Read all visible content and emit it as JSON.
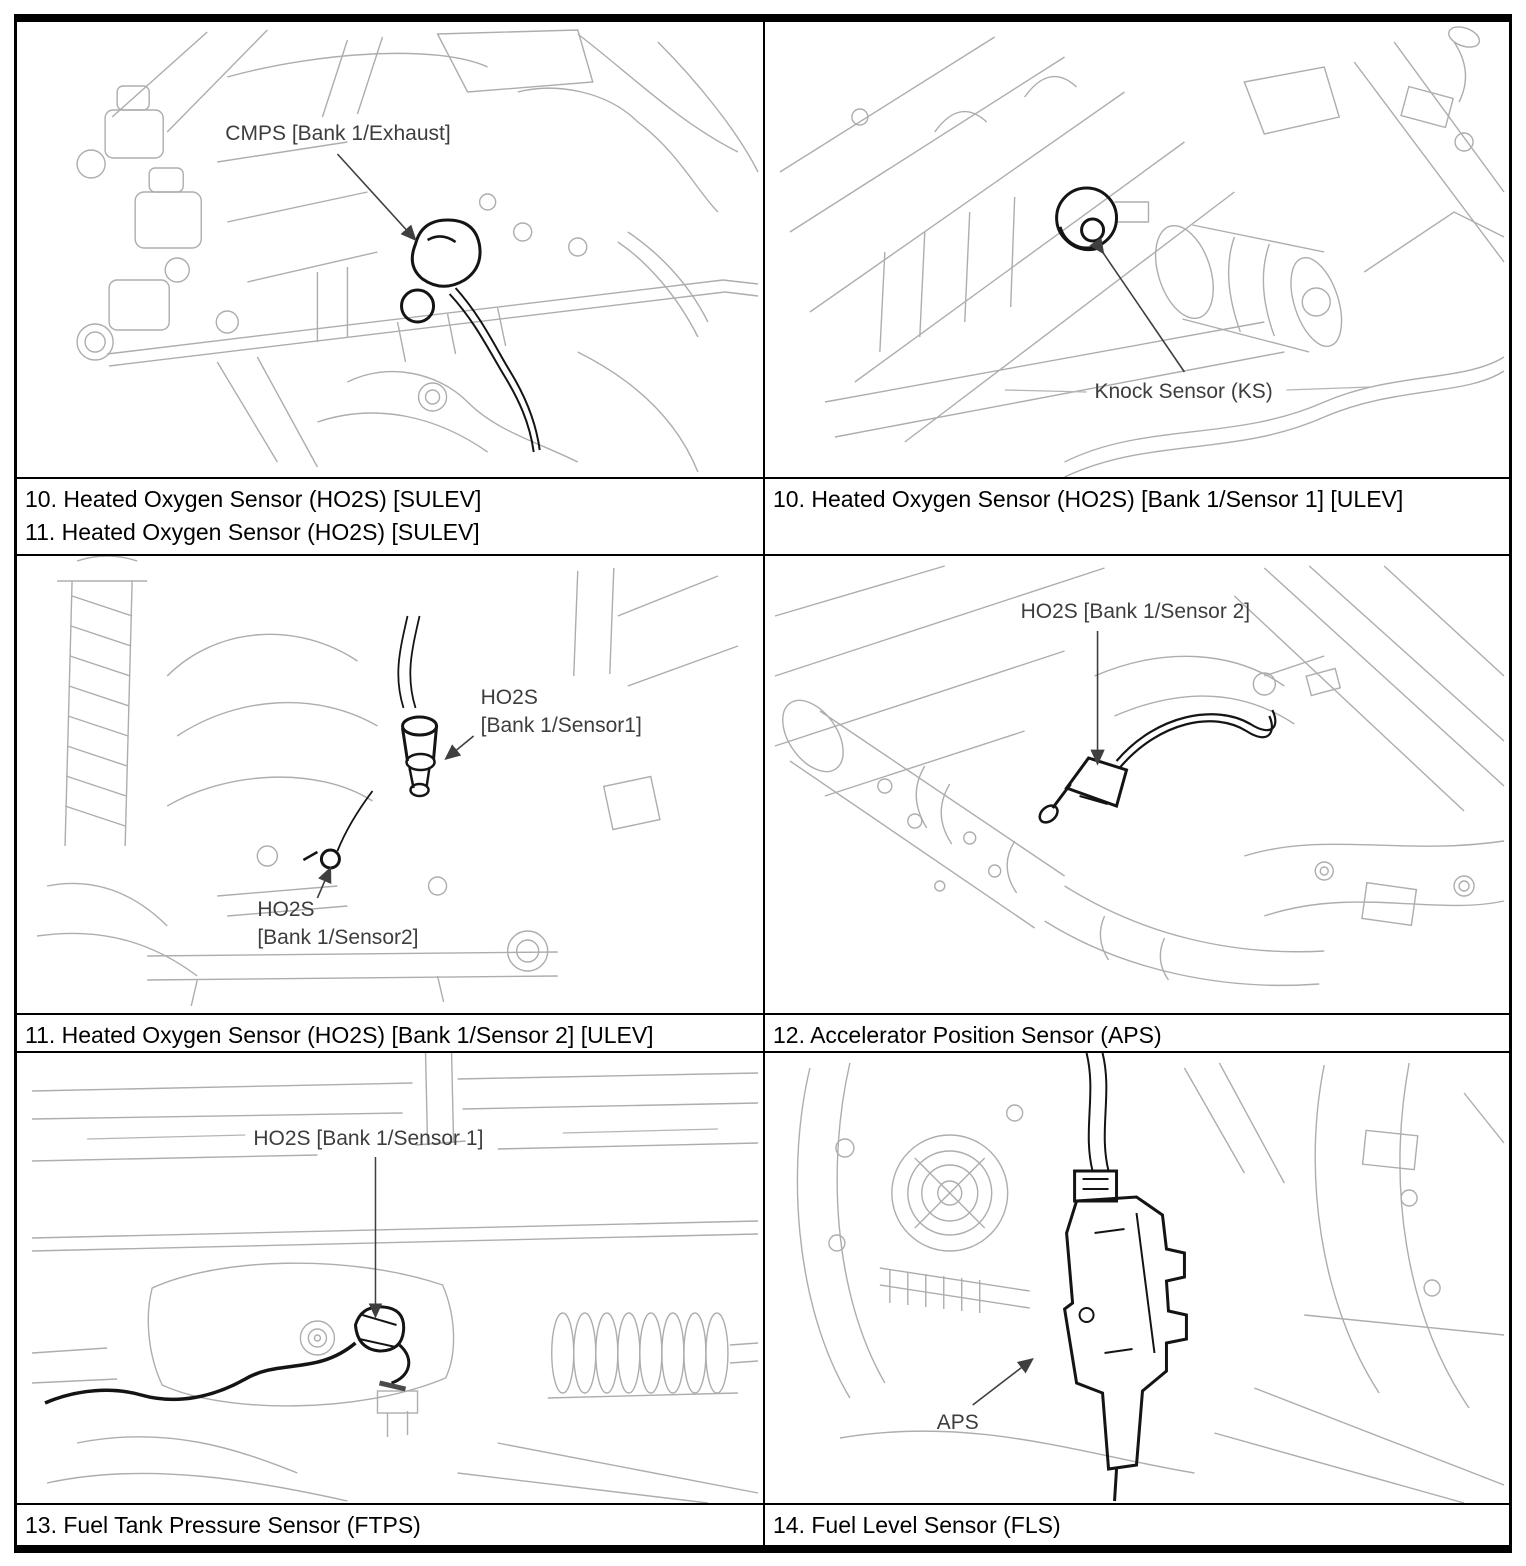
{
  "captions": {
    "row1_left_line1": "10. Heated Oxygen Sensor (HO2S) [SULEV]",
    "row1_left_line2": "11. Heated Oxygen Sensor (HO2S) [SULEV]",
    "row1_right": "10. Heated Oxygen Sensor (HO2S) [Bank 1/Sensor 1] [ULEV]",
    "row2_left": "11. Heated Oxygen Sensor (HO2S) [Bank 1/Sensor 2] [ULEV]",
    "row2_right": "12. Accelerator Position Sensor (APS)",
    "row3_left": "13. Fuel Tank Pressure Sensor (FTPS)",
    "row3_right": "14. Fuel Level Sensor (FLS)"
  },
  "figures": {
    "cmps": {
      "label": "CMPS [Bank 1/Exhaust]"
    },
    "knock": {
      "label": "Knock Sensor (KS)"
    },
    "ho2s_upper": {
      "line1": "HO2S",
      "line2": "[Bank 1/Sensor1]"
    },
    "ho2s_lower": {
      "line1": "HO2S",
      "line2": "[Bank 1/Sensor2]"
    },
    "ho2s_cat": {
      "label": "HO2S [Bank 1/Sensor 2]"
    },
    "ho2s_under": {
      "label": "HO2S [Bank 1/Sensor 1]"
    },
    "aps": {
      "label": "APS"
    }
  },
  "colors": {
    "border": "#000000",
    "caption_text": "#000000",
    "line_art_gray": "#a9a9a9",
    "sensor_highlight": "#141414",
    "figure_label_text": "#3d3d3d"
  }
}
